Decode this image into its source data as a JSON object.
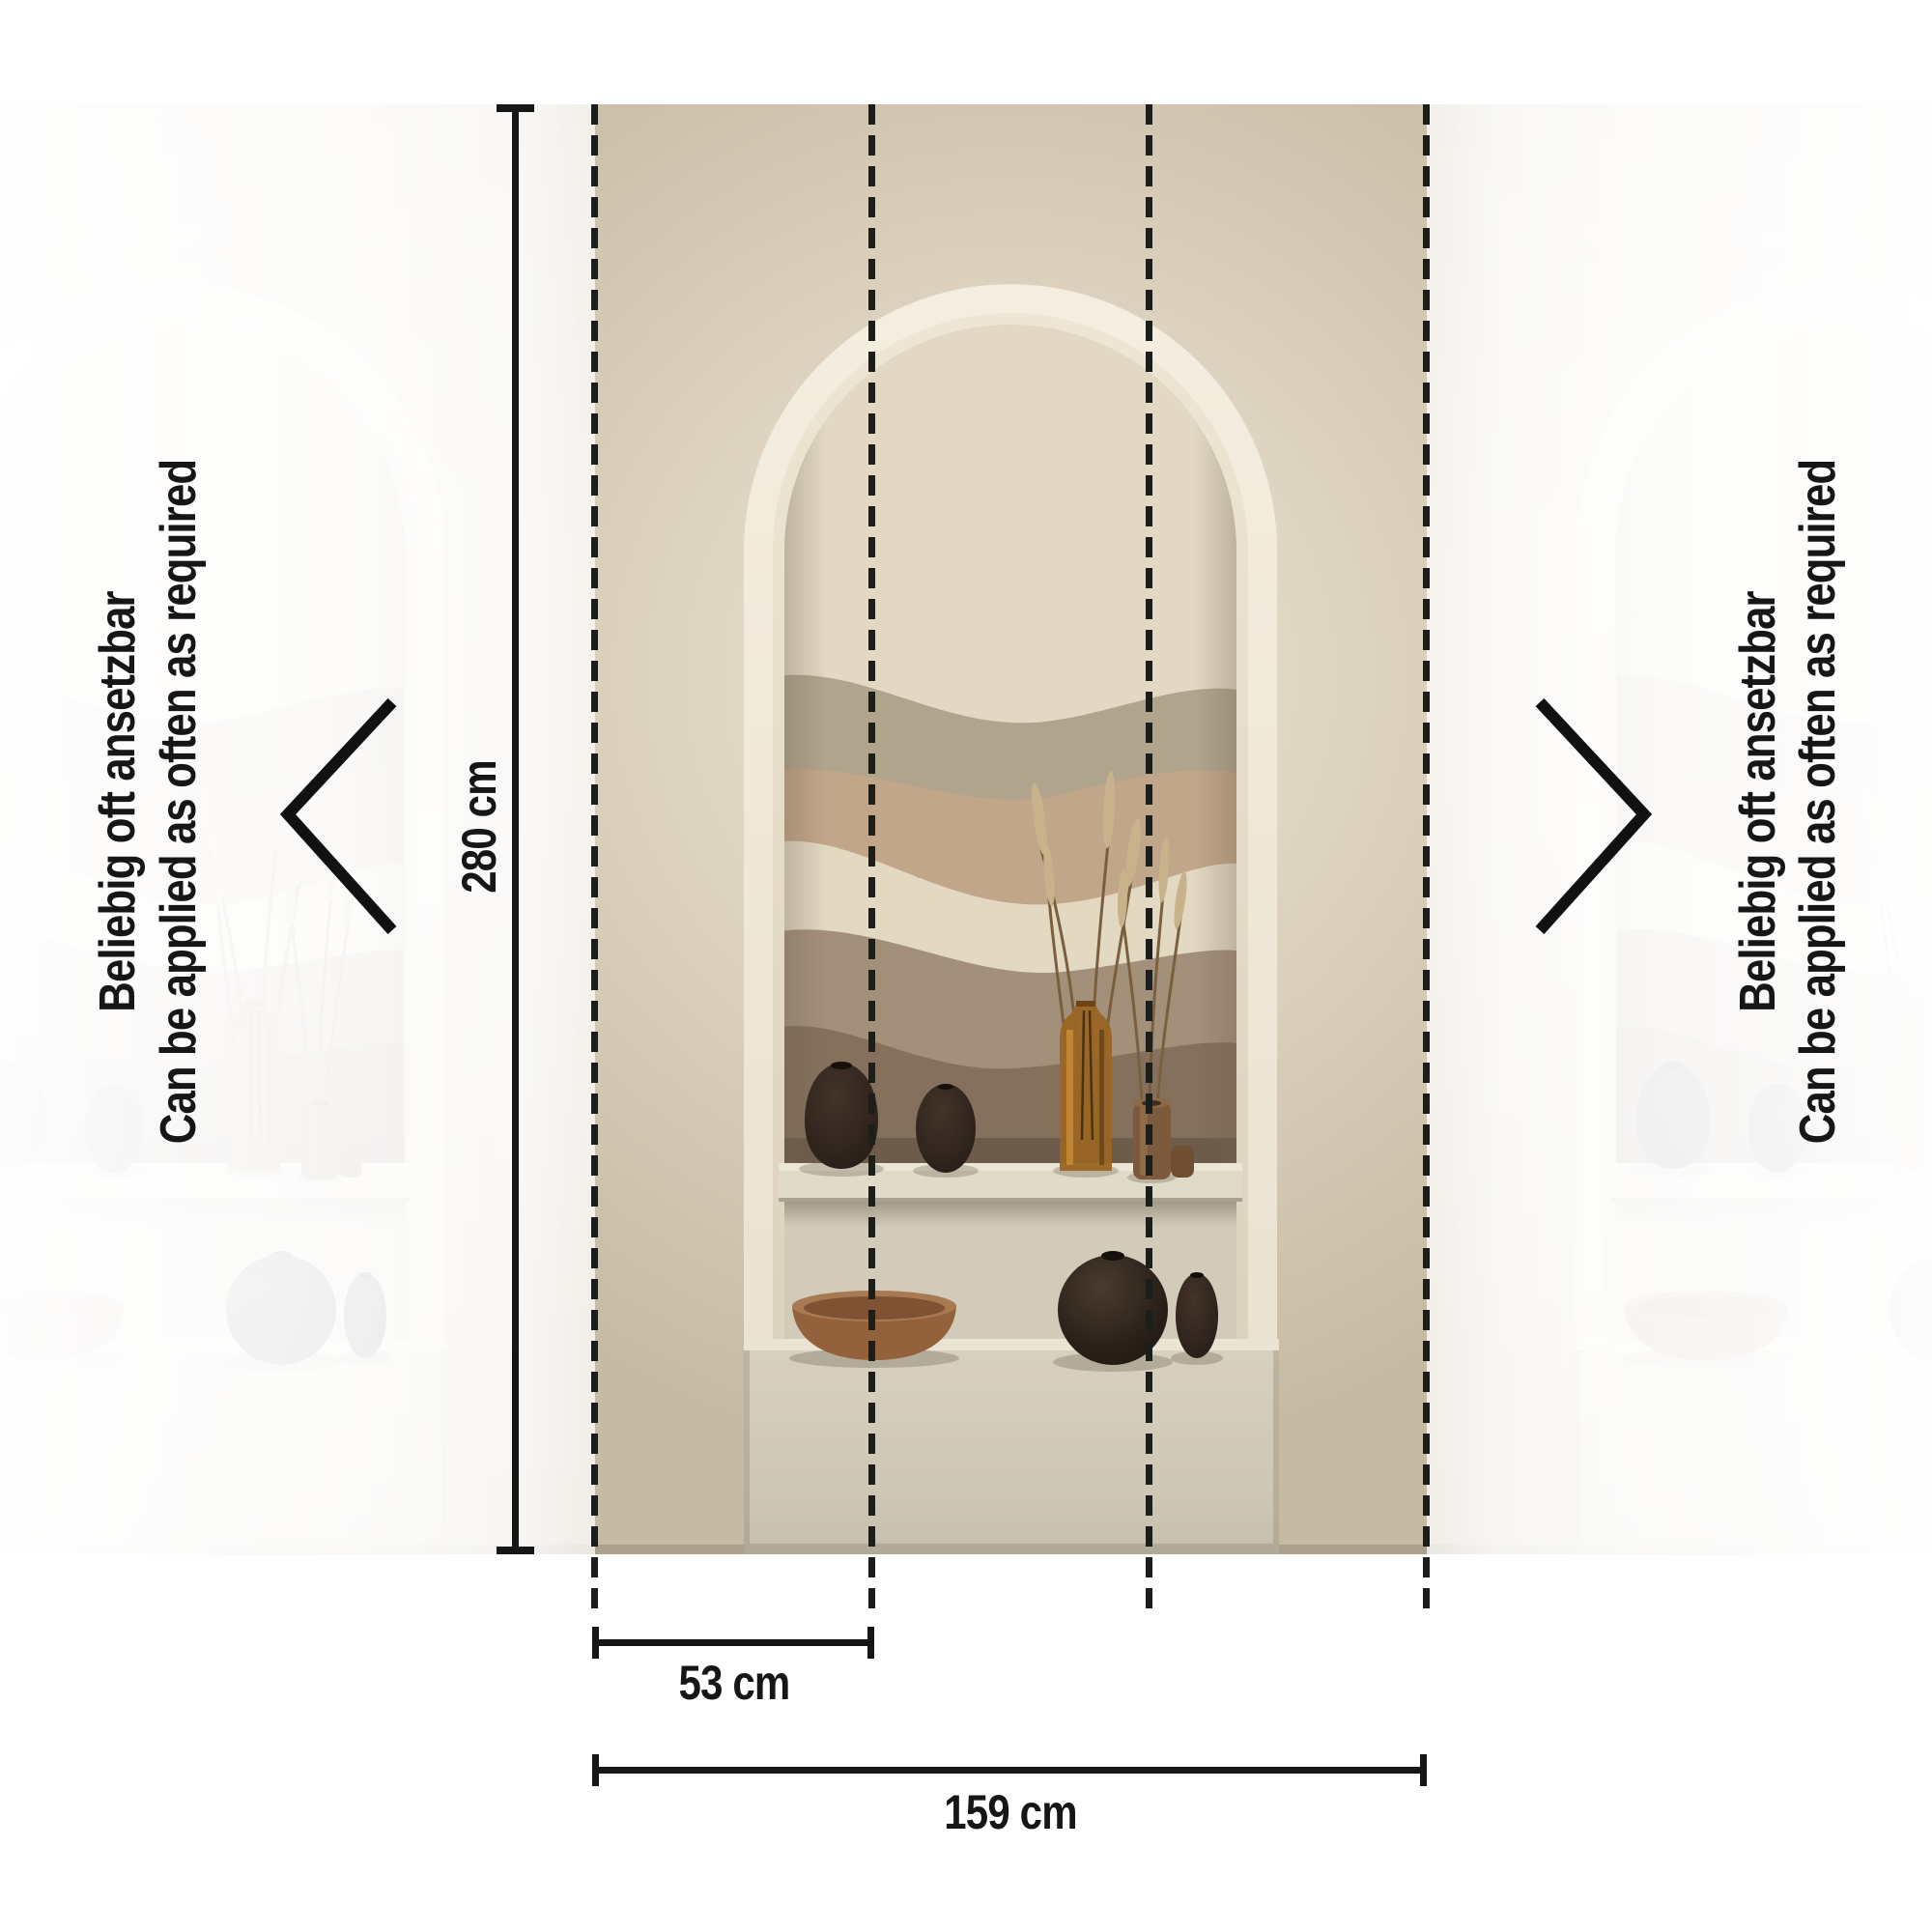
{
  "annotations": {
    "height_label": "280 cm",
    "strip_width_label": "53 cm",
    "total_width_label": "159 cm",
    "side_note_de": "Beliebig oft ansetzbar",
    "side_note_en": "Can be applied as often as required"
  },
  "dimensions": {
    "height_cm": 280,
    "strip_width_cm": 53,
    "total_width_cm": 159,
    "strips_between_guides": 3
  },
  "icons": {
    "left": "chevron-left-icon",
    "right": "chevron-right-icon"
  },
  "colors": {
    "annotation": "#161616",
    "dashed_guide": "#1b1e1a",
    "wall_tan": "#cabda6",
    "wall_light": "#ebe5d6",
    "arch_frame": "#f2ecde",
    "shelf": "#e0dac8",
    "plinth": "#d4cdbc",
    "mural_sky": "#e2d8c3",
    "mural_sage": "#b1a48d",
    "mural_blush": "#c2a68a",
    "mural_cream": "#e3d9c3",
    "mural_taupe": "#a3907a",
    "mural_brown": "#84705c",
    "black_vase": "#2d221b",
    "amber_bottle": "#9a6524",
    "wood_vase": "#7c5a3b",
    "bowl": "#96663f"
  },
  "scene": {
    "subject": "arched wall niche wallpaper mural with vases on two shelves",
    "objects": [
      "egg vase",
      "oval vase",
      "amber glass bottle with dried grass",
      "wooden cylinder vase",
      "terracotta bowl",
      "black sphere vase",
      "small black vase"
    ]
  }
}
